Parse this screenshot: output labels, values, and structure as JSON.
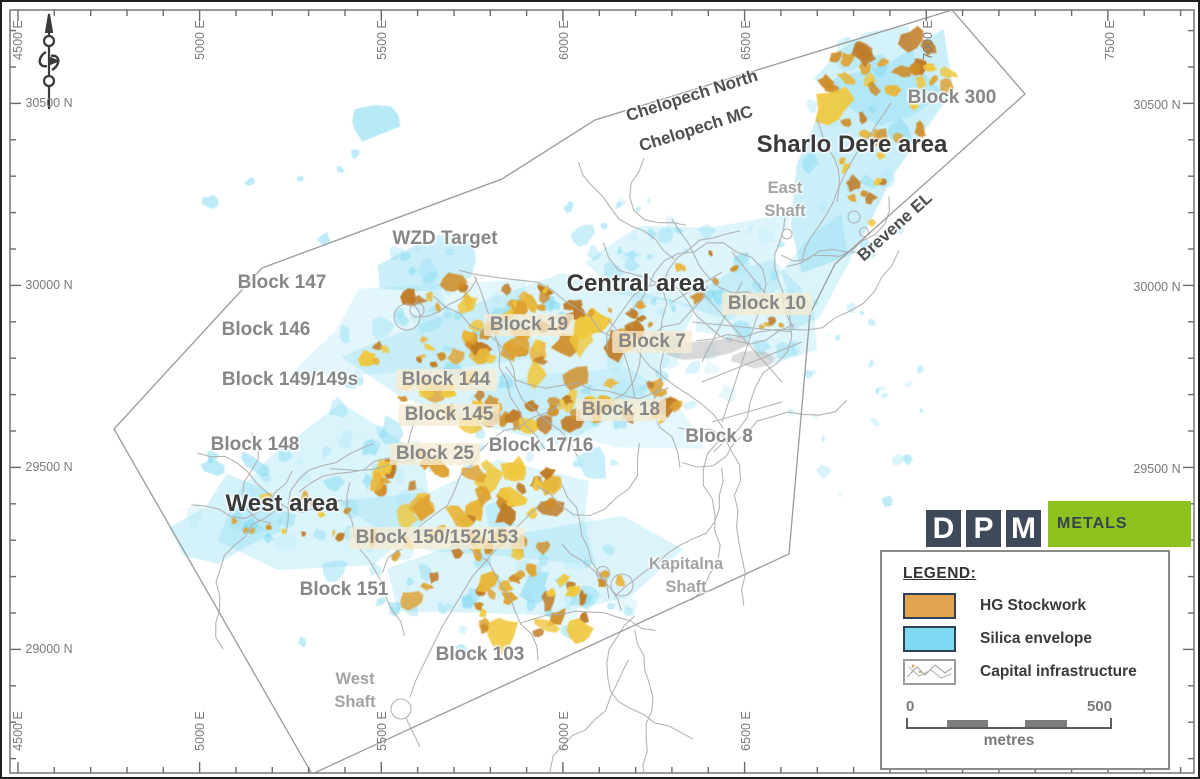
{
  "map": {
    "grid": {
      "top_labels": [
        {
          "text": "4500 E",
          "x": 16
        },
        {
          "text": "5000 E",
          "x": 198
        },
        {
          "text": "5500 E",
          "x": 380
        },
        {
          "text": "6000 E",
          "x": 562
        },
        {
          "text": "6500 E",
          "x": 744
        },
        {
          "text": "7000 E",
          "x": 926
        },
        {
          "text": "7500 E",
          "x": 1108
        }
      ],
      "bottom_labels": [
        {
          "text": "4500 E",
          "x": 16
        },
        {
          "text": "5000 E",
          "x": 198
        },
        {
          "text": "5500 E",
          "x": 380
        },
        {
          "text": "6000 E",
          "x": 562
        },
        {
          "text": "6500 E",
          "x": 744
        }
      ],
      "left_labels": [
        {
          "text": "30500 N",
          "y": 101
        },
        {
          "text": "30000 N",
          "y": 283
        },
        {
          "text": "29500 N",
          "y": 465
        },
        {
          "text": "29000 N",
          "y": 647
        }
      ],
      "right_labels": [
        {
          "text": "30500 N",
          "y": 103
        },
        {
          "text": "30000 N",
          "y": 285
        },
        {
          "text": "29500 N",
          "y": 467
        }
      ]
    },
    "area_labels": [
      {
        "text": "Sharlo Dere area",
        "x": 850,
        "y": 143
      },
      {
        "text": "Central area",
        "x": 634,
        "y": 282
      },
      {
        "text": "West area",
        "x": 280,
        "y": 502
      }
    ],
    "block_labels": [
      {
        "text": "Block 300",
        "x": 950,
        "y": 96,
        "highlight": false
      },
      {
        "text": "WZD Target",
        "x": 443,
        "y": 237,
        "highlight": false
      },
      {
        "text": "Block 147",
        "x": 280,
        "y": 281,
        "highlight": false
      },
      {
        "text": "Block 10",
        "x": 765,
        "y": 302,
        "highlight": true
      },
      {
        "text": "Block 146",
        "x": 264,
        "y": 328,
        "highlight": false
      },
      {
        "text": "Block 19",
        "x": 527,
        "y": 323,
        "highlight": true
      },
      {
        "text": "Block 7",
        "x": 650,
        "y": 340,
        "highlight": true
      },
      {
        "text": "Block 149/149s",
        "x": 288,
        "y": 378,
        "highlight": false
      },
      {
        "text": "Block 144",
        "x": 444,
        "y": 378,
        "highlight": true
      },
      {
        "text": "Block 145",
        "x": 447,
        "y": 413,
        "highlight": true
      },
      {
        "text": "Block 18",
        "x": 619,
        "y": 408,
        "highlight": true
      },
      {
        "text": "Block 148",
        "x": 253,
        "y": 443,
        "highlight": false
      },
      {
        "text": "Block 25",
        "x": 433,
        "y": 452,
        "highlight": true
      },
      {
        "text": "Block 17/16",
        "x": 539,
        "y": 444,
        "highlight": false
      },
      {
        "text": "Block 8",
        "x": 717,
        "y": 435,
        "highlight": false
      },
      {
        "text": "Block 150/152/153",
        "x": 435,
        "y": 536,
        "highlight": true
      },
      {
        "text": "Block 151",
        "x": 342,
        "y": 588,
        "highlight": false
      },
      {
        "text": "Block 103",
        "x": 478,
        "y": 653,
        "highlight": false
      }
    ],
    "shaft_labels": [
      {
        "lines": [
          "East",
          "Shaft"
        ],
        "x": 783,
        "y": 198
      },
      {
        "lines": [
          "Kapitalna",
          "Shaft"
        ],
        "x": 684,
        "y": 574
      },
      {
        "lines": [
          "West",
          "Shaft"
        ],
        "x": 353,
        "y": 689
      }
    ],
    "boundary_labels": [
      {
        "text": "Chelopech North",
        "x": 690,
        "y": 94,
        "rot": -17.5
      },
      {
        "text": "Chelopech MC",
        "x": 694,
        "y": 127,
        "rot": -17.5
      },
      {
        "text": "Brevene EL",
        "x": 893,
        "y": 225,
        "rot": -42
      }
    ]
  },
  "legend": {
    "title": "LEGEND:",
    "items": [
      {
        "key": "hg-stockwork",
        "label": "HG Stockwork",
        "swatch": "color"
      },
      {
        "key": "silica-envelope",
        "label": "Silica envelope",
        "swatch": "color"
      },
      {
        "key": "capital-infrastructure",
        "label": "Capital infrastructure",
        "swatch": "pattern"
      }
    ],
    "scale": {
      "start": "0",
      "end": "500",
      "unit": "metres"
    }
  },
  "logo": {
    "letters": [
      "D",
      "P",
      "M"
    ],
    "wordmark": "METALS"
  },
  "colors": {
    "hg_stockwork": "#e1a44f",
    "silica_envelope": "#7ed9f2",
    "infrastructure": "#adadad",
    "logo_navy": "#3e4a59",
    "logo_green": "#8dc21e",
    "block_label": "#878787",
    "area_label": "#3a3a3a"
  }
}
